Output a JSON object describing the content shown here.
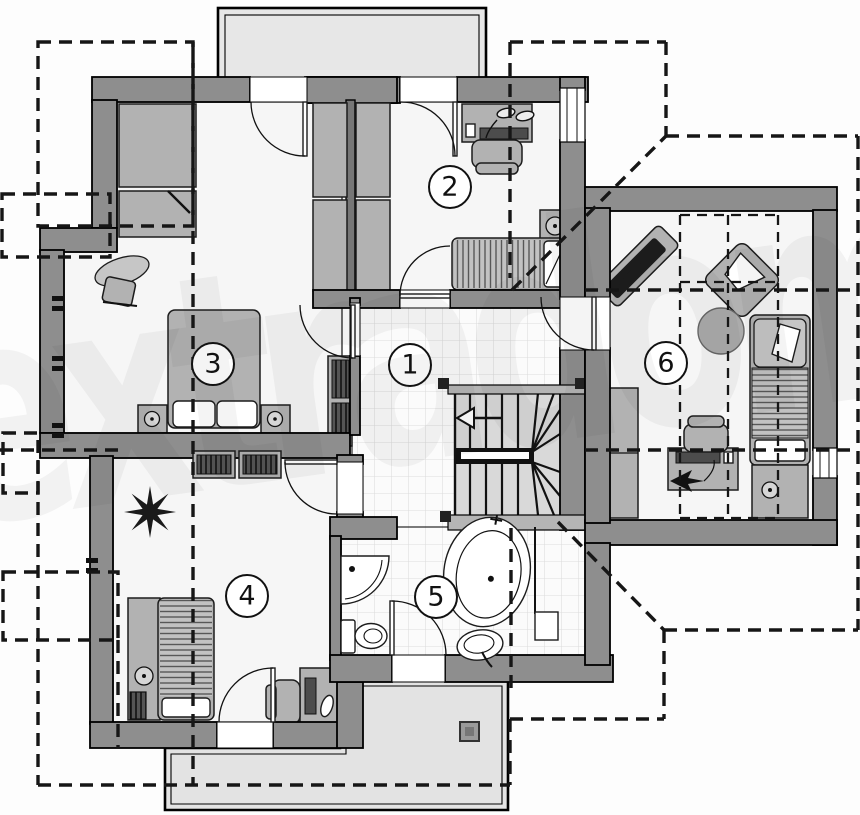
{
  "watermark": {
    "text": "extradom"
  },
  "plan": {
    "rooms": [
      {
        "number": "1"
      },
      {
        "number": "2"
      },
      {
        "number": "3"
      },
      {
        "number": "4"
      },
      {
        "number": "5"
      },
      {
        "number": "6"
      }
    ],
    "colors": {
      "wall": "#8e8e8e",
      "wall_dark": "#767676",
      "floor": "#f6f6f6",
      "tile_line": "#dcdcdc",
      "terrace": "#e3e3e3",
      "balcony": "#e7e7e7",
      "furniture": "#b2b2b2",
      "dark_fixture": "#4c4c4c",
      "roof_dash_line": "#161616"
    },
    "icons": {
      "stair_arrow": "left-triangle-arrow",
      "plant": "star-shaped-plant",
      "terrace_flue": "small-square",
      "desk_lamp_room2": "glasses-lamp",
      "desk_lamp_room6": "arrow-lamp"
    },
    "furniture_inventory": {
      "room_1": [
        "wall-shelf",
        "tiled-floor",
        "staircase"
      ],
      "room_2": [
        "desk",
        "desk-chair",
        "desk-lamp",
        "nightstand-with-lamp",
        "single-bed"
      ],
      "room_3": [
        "double-bed",
        "two-pillows",
        "nightstand-left",
        "nightstand-right",
        "vanity-table",
        "vanity-chair",
        "wardrobe-upper",
        "wardrobe-lower"
      ],
      "room_4": [
        "single-bed",
        "bedside-platform",
        "bedside-lamp",
        "radiator",
        "plant",
        "desk",
        "desk-chair",
        "wardrobe-pair"
      ],
      "room_5": [
        "corner-washbasin",
        "toilet",
        "oval-bathtub",
        "washbasin",
        "tiled-floor"
      ],
      "room_6": [
        "sofa-bench-diagonal",
        "armchair-diagonal",
        "round-rug",
        "single-bed-with-pillow",
        "bedside-cabinet",
        "tall-wardrobe",
        "desk",
        "desk-chair"
      ]
    },
    "outdoor": [
      "balcony-top",
      "terrace-bottom",
      "roof-outline-dashed"
    ]
  }
}
